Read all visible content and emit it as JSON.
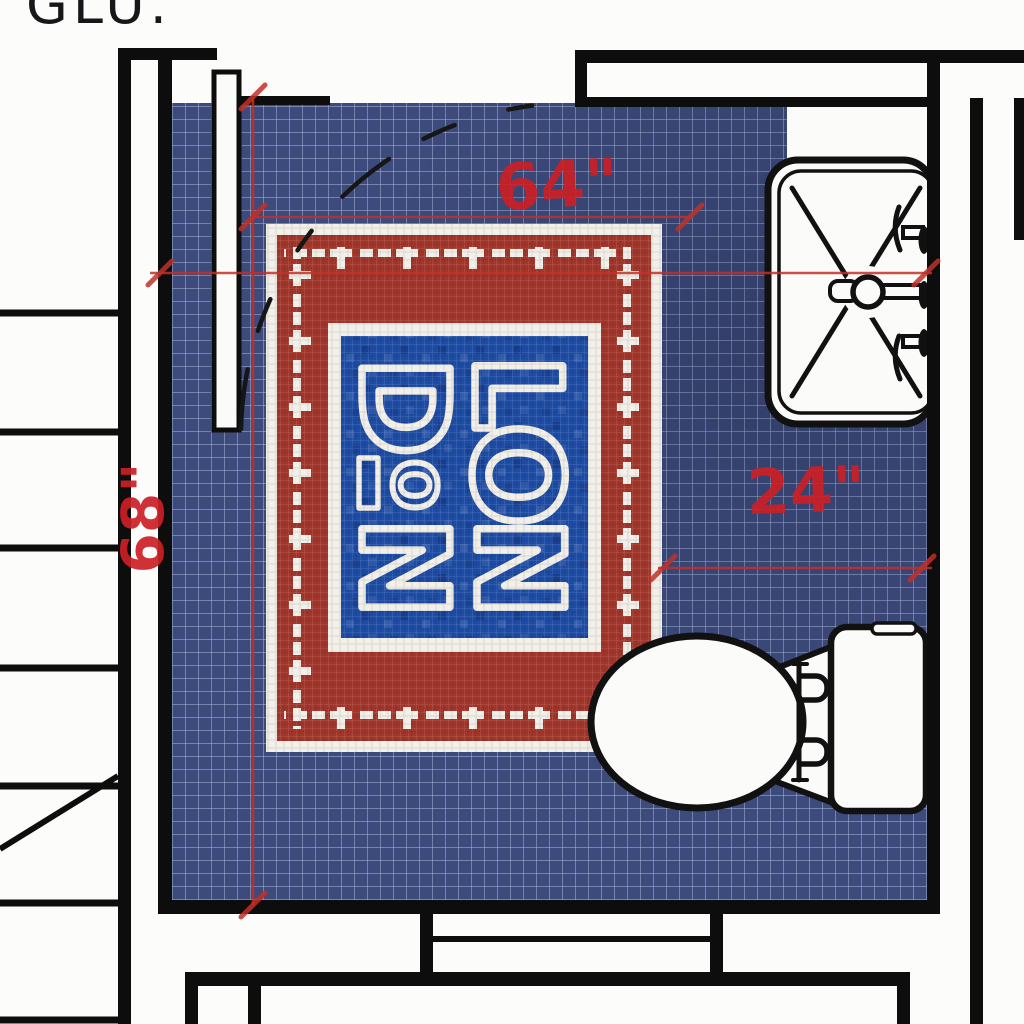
{
  "header": {
    "title_text": "GLU."
  },
  "dimension_labels": {
    "top": "64\"",
    "right": "24\"",
    "left": "68\""
  },
  "rug": {
    "mosaic_letters": [
      "D",
      "L",
      "I",
      "O",
      "O",
      "N",
      "N"
    ]
  },
  "colors": {
    "floor_tile_blue": "#3d4b7c",
    "rug_field_red": "#a3362b",
    "rug_tile_white": "#f2efe8",
    "center_panel_blue": "#1e4da6",
    "dimension_red": "#c9232a",
    "wall_black": "#0d0d0d"
  }
}
